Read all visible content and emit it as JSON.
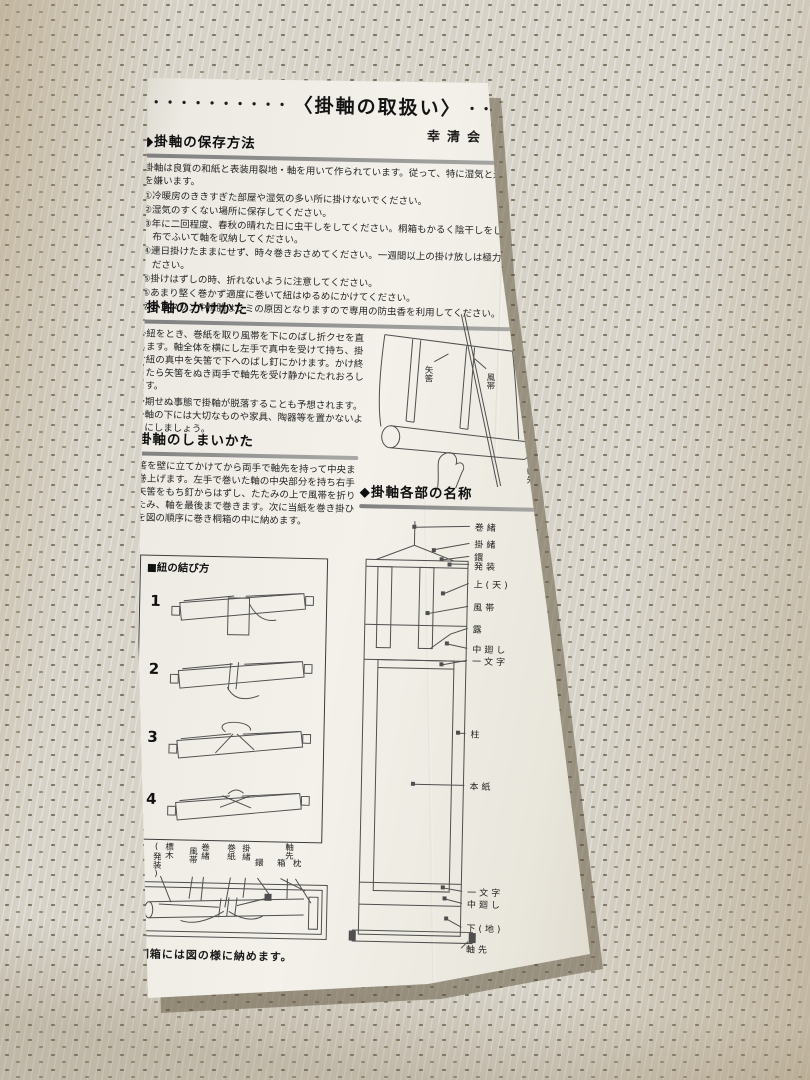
{
  "header": {
    "dots_left": "・・・・・・・・・・",
    "title": "〈掛軸の取扱い〉",
    "dots_right": "・・・・・・・・・・・・・",
    "organization": "幸清会"
  },
  "storage": {
    "heading": "◆掛軸の保存方法",
    "intro": "掛軸は良質の和紙と表装用裂地・軸を用いて作られています。従って、特に湿気と過度の乾燥を嫌います。",
    "points": [
      "①冷暖房のききすぎた部屋や湿気の多い所に掛けないでください。",
      "②湿気のすくない場所に保存してください。",
      "③年に二回程度、春秋の晴れた日に虫干しをしてください。桐箱もかるく陰干しをして乾いた布でふいて軸を収納してください。",
      "④連日掛けたままにせず、時々巻きおさめてください。一週間以上の掛け放しは極力さけてください。",
      "⑤掛けはずしの時、折れないように注意してください。",
      "⑥あまり堅く巻かず適度に巻いて紐はゆるめにかけてください。",
      "⑦ナフタリンや樟脳はシミの原因となりますので専用の防虫香を利用してください。"
    ]
  },
  "hanging": {
    "heading": "◆掛軸のかけかた",
    "body1": "掛紐をとき、巻紙を取り風帯を下にのばし折クセを直します。軸全体を横にし左手で真中を受けて持ち、掛け紐の真中を矢筈で下へのばし釘にかけます。かけ終ったら矢筈をぬき両手で軸先を受け静かにたれおろします。",
    "body2": "予期せぬ事態で掛軸が脱落することも予想されます。掛軸の下には大切なものや家具、陶器等を置かないようにしましょう。",
    "labels": {
      "yahazu": "矢筈",
      "futai": "風帯",
      "jikusaki": "軸先"
    }
  },
  "putting_away": {
    "heading": "◆掛軸のしまいかた",
    "body": "矢筈を壁に立てかけてから両手で軸先を持って中央まで巻上げます。左手で巻いた軸の中央部分を持ち右手で矢筈をもち釘からはずし、たたみの上で風帯を折りたたみ、軸を最後まで巻きます。次に当紙を巻き掛ひもを図の順序に巻き桐箱の中に納めます。"
  },
  "knot": {
    "heading": "■紐の結び方",
    "steps": [
      "1",
      "2",
      "3",
      "4"
    ]
  },
  "parts": {
    "heading": "◆掛軸各部の名称",
    "labels": [
      "巻緒",
      "掛緒",
      "鐶",
      "発装",
      "上(天)",
      "風帯",
      "露",
      "中廻し",
      "一文字",
      "柱",
      "本紙",
      "一文字",
      "中廻し",
      "下(地)",
      "軸先"
    ]
  },
  "box": {
    "labels": [
      "標木",
      "(発装)",
      "風帯",
      "巻緒",
      "巻紙",
      "掛緒",
      "鐶",
      "箱",
      "軸先",
      "枕"
    ],
    "caption": "桐箱には図の様に納めます。"
  },
  "colors": {
    "paper": "#f0eee7",
    "carpet_base": "#d6d2c7",
    "carpet_fleck": "#7e7564",
    "ink": "#262626",
    "rule_gray": "#9a9a99"
  }
}
